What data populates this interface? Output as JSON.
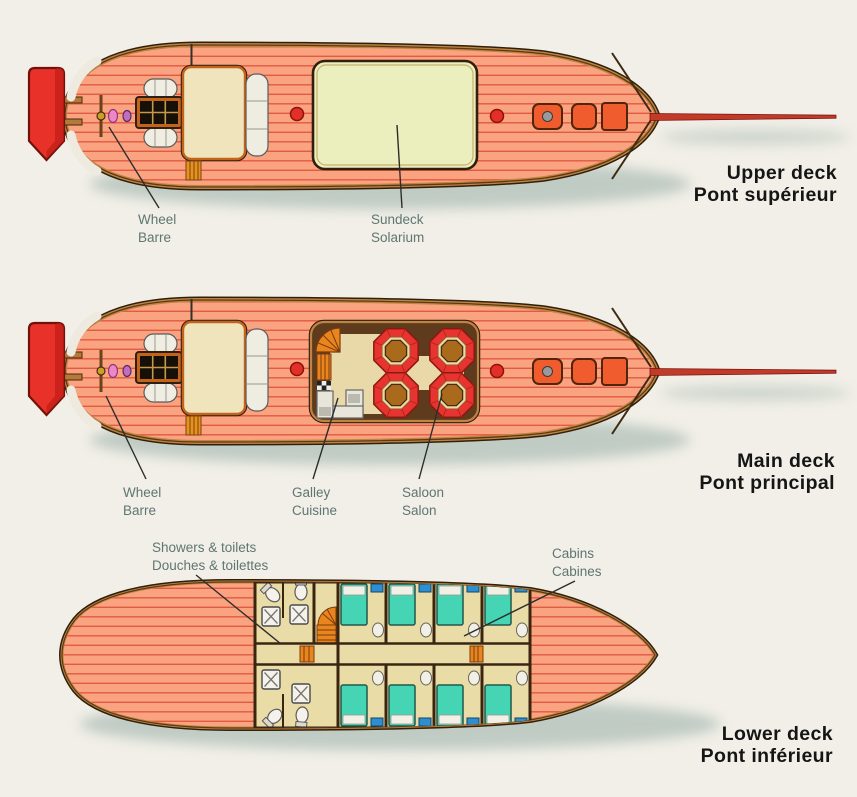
{
  "diagram": {
    "type": "boat-deck-plans",
    "decks": [
      {
        "title_en": "Upper deck",
        "title_fr": "Pont supérieur",
        "labels": {
          "wheel": {
            "en": "Wheel",
            "fr": "Barre"
          },
          "sundeck": {
            "en": "Sundeck",
            "fr": "Solarium"
          }
        }
      },
      {
        "title_en": "Main deck",
        "title_fr": "Pont principal",
        "labels": {
          "wheel": {
            "en": "Wheel",
            "fr": "Barre"
          },
          "galley": {
            "en": "Galley",
            "fr": "Cuisine"
          },
          "saloon": {
            "en": "Saloon",
            "fr": "Salon"
          }
        }
      },
      {
        "title_en": "Lower deck",
        "title_fr": "Pont inférieur",
        "labels": {
          "showers": {
            "en": "Showers & toilets",
            "fr": "Douches & toilettes"
          },
          "cabins": {
            "en": "Cabins",
            "fr": "Cabines"
          }
        }
      }
    ],
    "palette": {
      "background": "#f1efe7",
      "hull": "#f9a381",
      "plank_line": "#e25a42",
      "hull_outline": "#2f1f0c",
      "gunwale": "#c08442",
      "dinghy_red": "#e83128",
      "sundeck": "#ebeebd",
      "deckhouse": "#efe4bb",
      "saloon_floor": "#5f3b1d",
      "saloon_walkway": "#ead9a8",
      "seat_red": "#e73430",
      "table_brown": "#aa6a1c",
      "stairs_orange": "#e8851c",
      "hatch_orange": "#f15c2e",
      "cabin_bed_teal": "#45d4b4",
      "cabin_floor": "#e9dca6",
      "accent_blue": "#2e8fd0",
      "label_text": "#5f7672",
      "title_text": "#151515",
      "shadow": "#8fa8a1"
    }
  }
}
